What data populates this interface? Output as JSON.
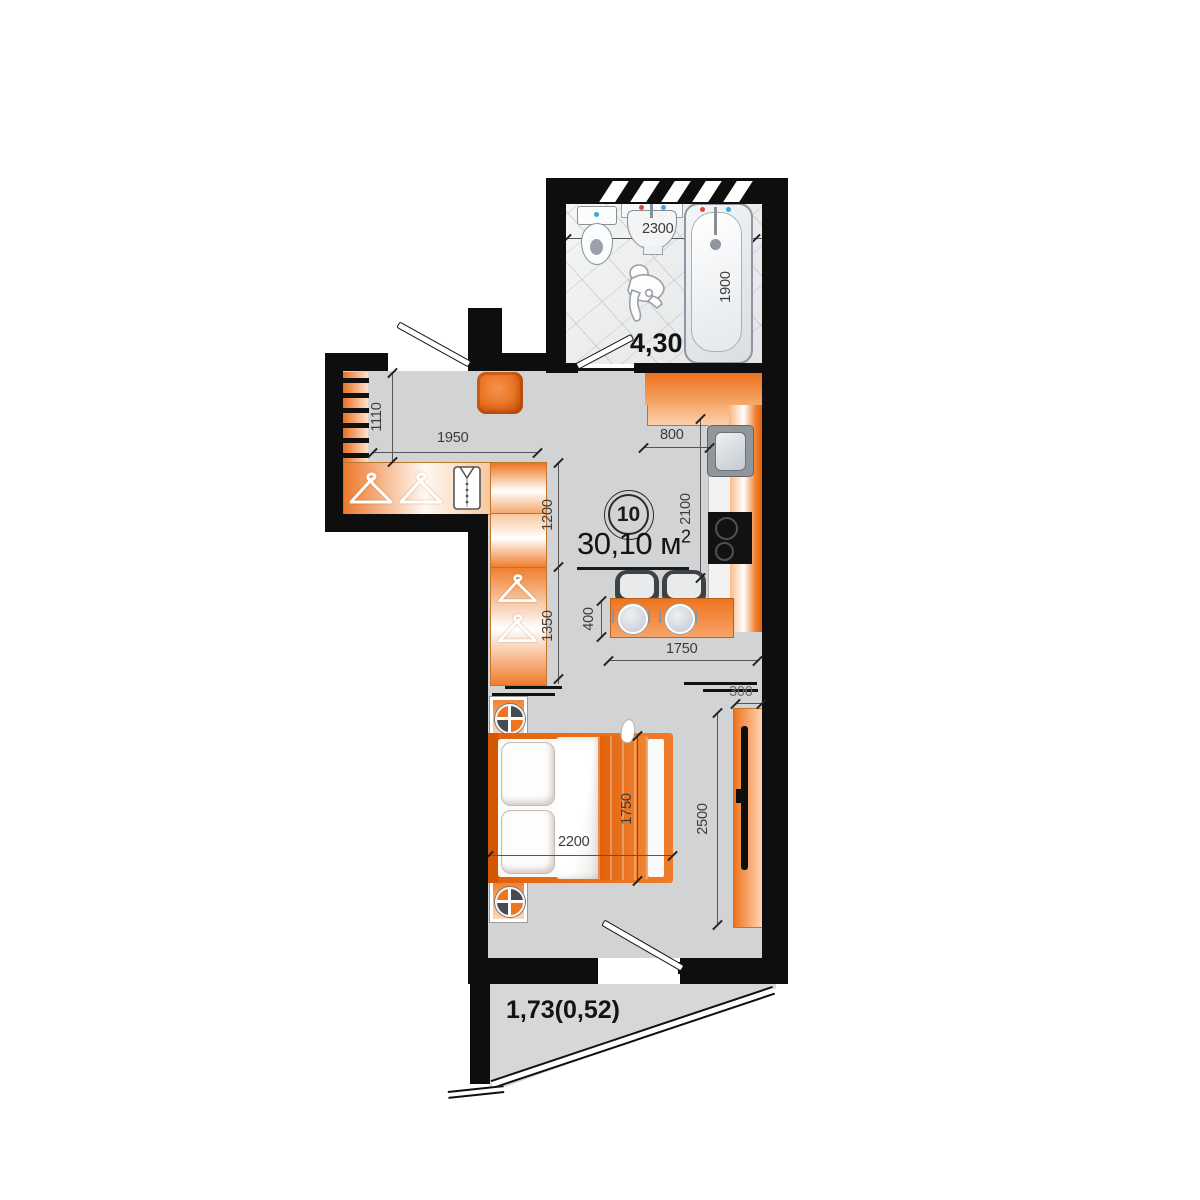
{
  "unit": {
    "number": "10",
    "area": "30,10 м",
    "area_sup": "2"
  },
  "rooms": {
    "bathroom_area": "4,30",
    "balcony_area": "1,73(0,52)"
  },
  "dimensions": {
    "bathroom_width": "2300",
    "bathtub_length": "1900",
    "entry_depth": "1110",
    "entry_width": "1950",
    "kitchen_corner": "800",
    "kitchen_run": "2100",
    "closet_upper": "1200",
    "closet_lower": "1350",
    "bar_depth": "400",
    "bar_width": "1750",
    "tv_depth": "300",
    "bedroom_depth": "2500",
    "bed_width": "2200",
    "bed_depth": "1750"
  },
  "colors": {
    "wall": "#0e0e0e",
    "floor": "#d2d3d4",
    "accent_orange": "#ee7420",
    "deep_orange": "#e2610a"
  }
}
